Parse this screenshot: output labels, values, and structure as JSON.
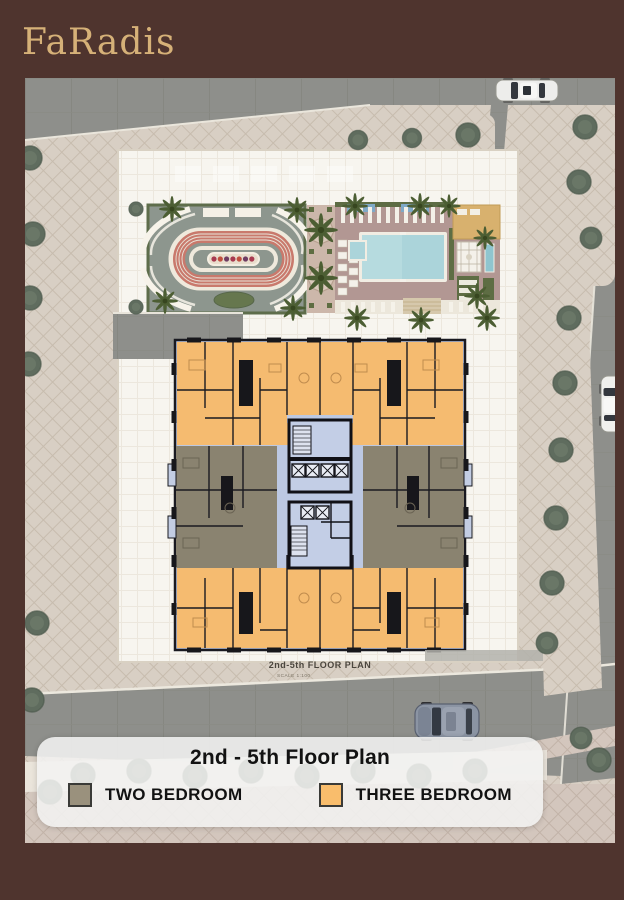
{
  "page": {
    "background_color": "#4F342E"
  },
  "brand": {
    "logo_text": "FaRadis",
    "logo_color": "#D6B178"
  },
  "site_plan": {
    "caption_title": "2nd-5th FLOOR PLAN",
    "caption_scale": "SCALE 1:100",
    "colors": {
      "two_bedroom_units": "#8A8370",
      "three_bedroom_units": "#F5BB70",
      "core_circulation": "#C3CEE6",
      "pool_water": "#ABD4DA",
      "running_track": "#C9796C",
      "plaza_paving": "#D8CFC4",
      "road": "#8E8F8B",
      "podium": "#F7F5EF"
    }
  },
  "legend": {
    "title": "2nd - 5th Floor Plan",
    "items": [
      {
        "label": "TWO BEDROOM",
        "color": "#9A917D"
      },
      {
        "label": "THREE BEDROOM",
        "color": "#F9BD6C"
      }
    ]
  }
}
